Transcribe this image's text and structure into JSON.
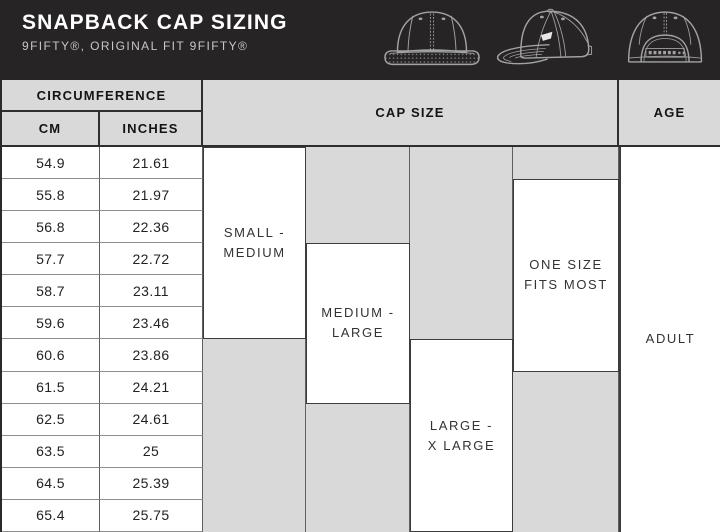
{
  "header": {
    "title": "SNAPBACK CAP SIZING",
    "subtitle": "9FIFTY®, ORIGINAL FIT 9FIFTY®",
    "icons": [
      "cap-front-icon",
      "cap-side-icon",
      "cap-back-icon"
    ],
    "bar_color": "#262424",
    "title_color": "#ffffff",
    "subtitle_color": "#c7c7c7",
    "icon_stroke_color": "#a3a3a3"
  },
  "table": {
    "headers": {
      "circumference": "CIRCUMFERENCE",
      "cm": "CM",
      "inches": "INCHES",
      "cap_size": "CAP SIZE",
      "age": "AGE"
    },
    "rows": [
      {
        "cm": "54.9",
        "inches": "21.61"
      },
      {
        "cm": "55.8",
        "inches": "21.97"
      },
      {
        "cm": "56.8",
        "inches": "22.36"
      },
      {
        "cm": "57.7",
        "inches": "22.72"
      },
      {
        "cm": "58.7",
        "inches": "23.11"
      },
      {
        "cm": "59.6",
        "inches": "23.46"
      },
      {
        "cm": "60.6",
        "inches": "23.86"
      },
      {
        "cm": "61.5",
        "inches": "24.21"
      },
      {
        "cm": "62.5",
        "inches": "24.61"
      },
      {
        "cm": "63.5",
        "inches": "25"
      },
      {
        "cm": "64.5",
        "inches": "25.39"
      },
      {
        "cm": "65.4",
        "inches": "25.75"
      }
    ],
    "sizes": [
      {
        "line1": "SMALL -",
        "line2": "MEDIUM",
        "cm_range": "54.9–59.6"
      },
      {
        "line1": "MEDIUM -",
        "line2": "LARGE",
        "cm_range": "57.7–61.5"
      },
      {
        "line1": "LARGE -",
        "line2": "X LARGE",
        "cm_range": "60.6–65.4"
      },
      {
        "line1": "ONE SIZE",
        "line2": "FITS MOST",
        "cm_range": "55.8–60.6"
      }
    ],
    "age_value": "ADULT",
    "colors": {
      "header_bg": "#d9d9d9",
      "shaded_cell_bg": "#d9d9d9",
      "active_cell_bg": "#ffffff",
      "header_border": "#2e2e2e",
      "body_border": "#8e8e8e",
      "box_border": "#3c3c3c"
    }
  }
}
